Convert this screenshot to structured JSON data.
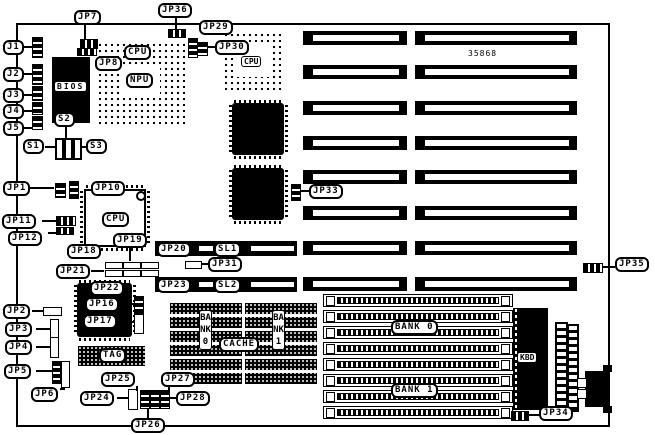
{
  "diagram": {
    "type": "motherboard jumper location diagram",
    "part_number": "35868",
    "foreground": "#000000",
    "background": "#ffffff"
  },
  "expansion": {
    "slot_rows": 8
  },
  "memory": {
    "simm_sockets": 8
  },
  "labels": {
    "jp7": "JP7",
    "jp36": "JP36",
    "jp29": "JP29",
    "jp30": "JP30",
    "jp8": "JP8",
    "j1": "J1",
    "j2": "J2",
    "j3": "J3",
    "j4": "J4",
    "j5": "J5",
    "bios": "BIOS",
    "cpu_socket1": "CPU",
    "npu": "NPU",
    "cpu_socket2": "CPU",
    "cpu_qfp": "CPU",
    "s1": "S1",
    "s2": "S2",
    "s3": "S3",
    "jp1": "JP1",
    "jp10": "JP10",
    "jp11": "JP11",
    "jp12": "JP12",
    "jp18": "JP18",
    "jp19": "JP19",
    "jp20": "JP20",
    "sl1": "SL1",
    "jp21": "JP21",
    "jp31": "JP31",
    "jp23": "JP23",
    "sl2": "SL2",
    "jp22": "JP22",
    "jp16": "JP16",
    "jp17": "JP17",
    "jp2": "JP2",
    "jp3": "JP3",
    "jp4": "JP4",
    "jp5": "JP5",
    "jp6": "JP6",
    "tag": "TAG",
    "cache": "CACHE",
    "bank0_dip": "BANK0",
    "bank1_dip": "BANK1",
    "jp24": "JP24",
    "jp25": "JP25",
    "jp26": "JP26",
    "jp27": "JP27",
    "jp28": "JP28",
    "bank0_simm": "BANK 0",
    "bank1_simm": "BANK 1",
    "kbd": "KBD",
    "jp33": "JP33",
    "jp34": "JP34",
    "jp35": "JP35"
  }
}
